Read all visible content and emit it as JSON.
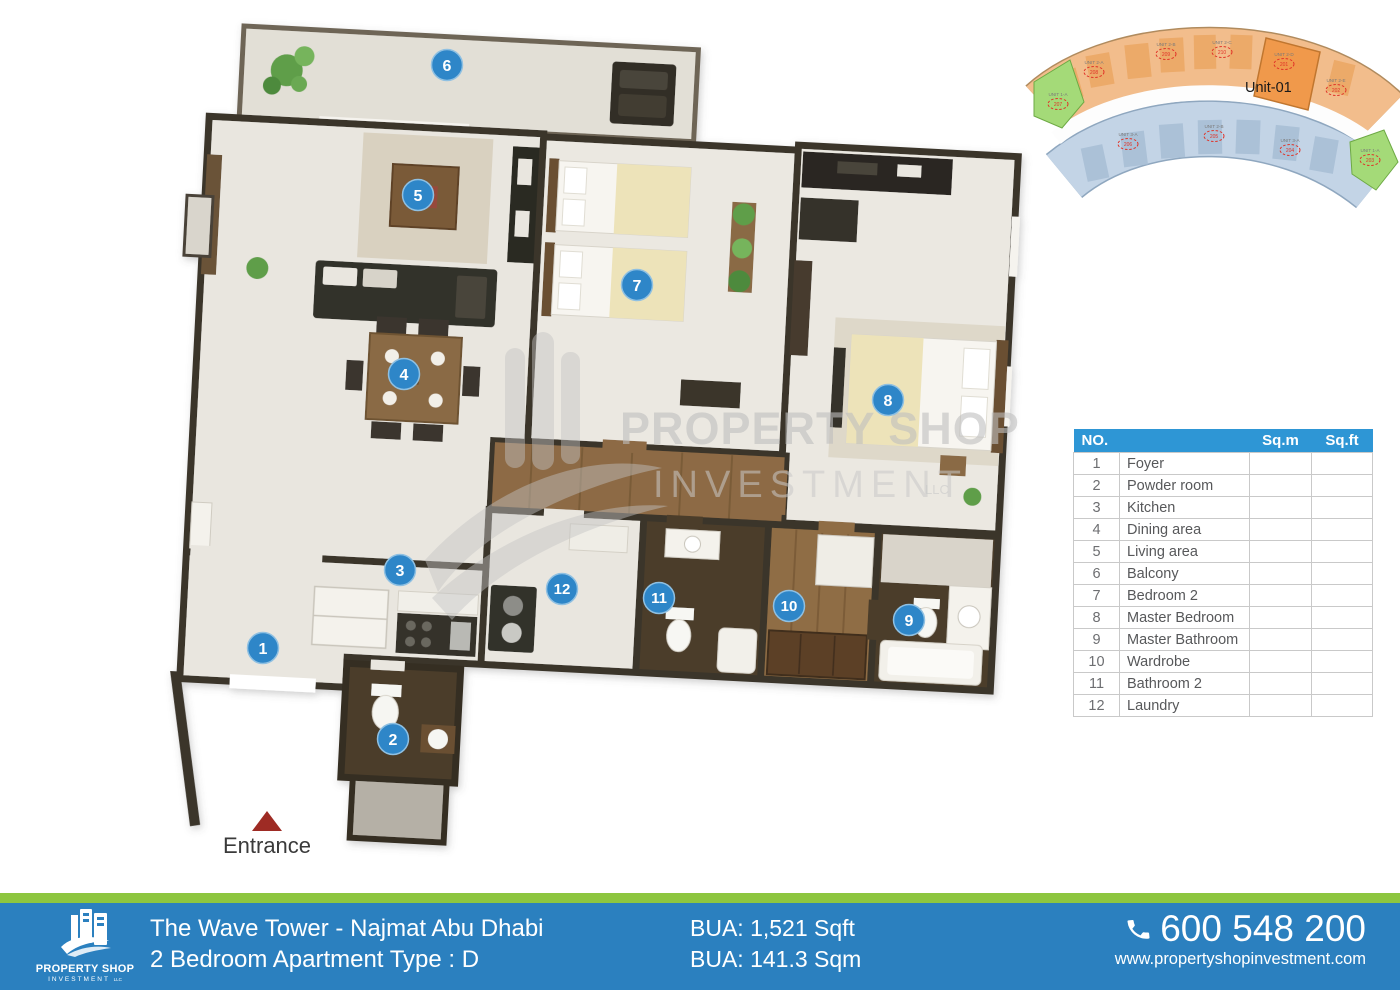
{
  "plan": {
    "entrance_label": "Entrance",
    "markers": [
      "1",
      "2",
      "3",
      "4",
      "5",
      "6",
      "7",
      "8",
      "9",
      "10",
      "11",
      "12"
    ],
    "legend": [
      "Foyer",
      "Powder room",
      "Kitchen",
      "Dining area",
      "Living area",
      "Balcony",
      "Bedroom 2",
      "Master Bedroom",
      "Master Bathroom",
      "Wardrobe",
      "Bathroom 2",
      "Laundry"
    ]
  },
  "watermark": {
    "line1": "PROPERTY SHOP",
    "line2": "INVESTMENT",
    "suffix": "LLC"
  },
  "unit_map": {
    "highlight_label": "Unit-01",
    "units": [
      {
        "name": "UNIT 2-A",
        "num": "208"
      },
      {
        "name": "UNIT 2-B",
        "num": "209"
      },
      {
        "name": "UNIT 2-C",
        "num": "210"
      },
      {
        "name": "UNIT 2-D",
        "num": "201"
      },
      {
        "name": "UNIT 2-E",
        "num": "202"
      },
      {
        "name": "UNIT 1-A",
        "num": "207"
      },
      {
        "name": "UNIT 3-A",
        "num": "206"
      },
      {
        "name": "UNIT 2-B",
        "num": "205"
      },
      {
        "name": "UNIT 3-A",
        "num": "204"
      },
      {
        "name": "UNIT 1-A",
        "num": "203"
      }
    ]
  },
  "table": {
    "headers": {
      "no": "NO.",
      "sqm": "Sq.m",
      "sqft": "Sq.ft"
    },
    "rows": [
      {
        "no": "1",
        "name": "Foyer",
        "sqm": "",
        "sqft": ""
      },
      {
        "no": "2",
        "name": "Powder room",
        "sqm": "",
        "sqft": ""
      },
      {
        "no": "3",
        "name": "Kitchen",
        "sqm": "",
        "sqft": ""
      },
      {
        "no": "4",
        "name": "Dining area",
        "sqm": "",
        "sqft": ""
      },
      {
        "no": "5",
        "name": "Living area",
        "sqm": "",
        "sqft": ""
      },
      {
        "no": "6",
        "name": "Balcony",
        "sqm": "",
        "sqft": ""
      },
      {
        "no": "7",
        "name": "Bedroom 2",
        "sqm": "",
        "sqft": ""
      },
      {
        "no": "8",
        "name": "Master Bedroom",
        "sqm": "",
        "sqft": ""
      },
      {
        "no": "9",
        "name": "Master Bathroom",
        "sqm": "",
        "sqft": ""
      },
      {
        "no": "10",
        "name": "Wardrobe",
        "sqm": "",
        "sqft": ""
      },
      {
        "no": "11",
        "name": "Bathroom 2",
        "sqm": "",
        "sqft": ""
      },
      {
        "no": "12",
        "name": "Laundry",
        "sqm": "",
        "sqft": ""
      }
    ]
  },
  "footer": {
    "brand": {
      "name": "PROPERTY SHOP",
      "sub": "INVESTMENT",
      "sub2": "LLC"
    },
    "title_line1": "The Wave Tower - Najmat Abu Dhabi",
    "title_line2": "2 Bedroom Apartment Type : D",
    "bua_line1": "BUA: 1,521 Sqft",
    "bua_line2": "BUA: 141.3 Sqm",
    "phone": "600 548 200",
    "website": "www.propertyshopinvestment.com"
  },
  "colors": {
    "marker_blue": "#2e86c8",
    "table_header_blue": "#2e96d5",
    "footer_blue": "#2b80bf",
    "footer_green": "#8dc63f",
    "entrance_red": "#9e2b24",
    "wall_dark": "#3b352b",
    "map_orange": "#f0b277",
    "map_blue": "#c3d4e6",
    "map_green": "#a4da78"
  }
}
